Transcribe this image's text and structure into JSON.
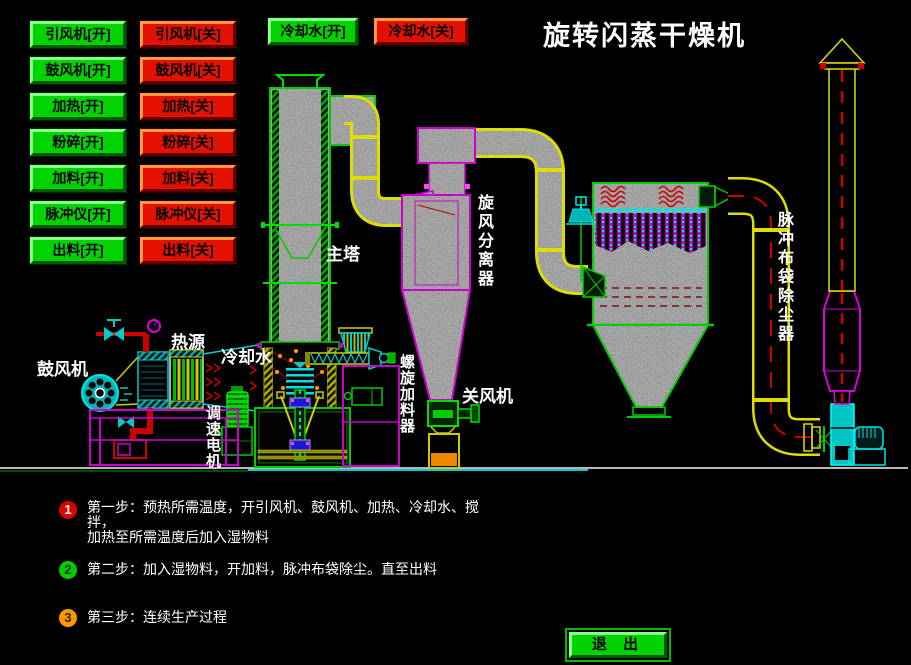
{
  "title": "旋转闪蒸干燥机",
  "buttons": {
    "on": [
      "引风机[开]",
      "鼓风机[开]",
      "加热[开]",
      "粉碎[开]",
      "加料[开]",
      "脉冲仪[开]",
      "出料[开]"
    ],
    "off": [
      "引风机[关]",
      "鼓风机[关]",
      "加热[关]",
      "粉碎[关]",
      "加料[关]",
      "脉冲仪[关]",
      "出料[关]"
    ],
    "cooling_on": "冷却水[开]",
    "cooling_off": "冷却水[关]",
    "exit": "退 出"
  },
  "labels": {
    "blower": "鼓风机",
    "heat_source": "热源",
    "cooling_water": "冷却水",
    "main_tower": "主塔",
    "cyclone_separator": "旋风分离器",
    "rotary_valve": "关风机",
    "pulse_bag_filter": "脉冲布袋除尘器",
    "speed_motor": "调速电机",
    "screw_feeder": "螺旋加料器"
  },
  "steps": [
    {
      "num": "1",
      "color": "#e00000",
      "num_color": "#ffffff",
      "line1": "第一步：预热所需温度，开引风机、鼓风机、加热、冷却水、搅拌，",
      "line2": "加热至所需温度后加入湿物料"
    },
    {
      "num": "2",
      "color": "#00cc00",
      "num_color": "#013301",
      "line1": "第二步：加入湿物料，开加料，脉冲布袋除尘。直至出料",
      "line2": ""
    },
    {
      "num": "3",
      "color": "#ff9900",
      "num_color": "#332200",
      "line1": "第三步：连续生产过程",
      "line2": ""
    }
  ],
  "colors": {
    "on_button": "#00d400",
    "off_button": "#e41000",
    "pipe_yellow": "#dddd00",
    "equipment_green": "#00cc00",
    "equipment_magenta": "#cc00cc",
    "equipment_cyan": "#00e5e5",
    "flow_red": "#cc0000",
    "material_orange": "#ee8800"
  }
}
